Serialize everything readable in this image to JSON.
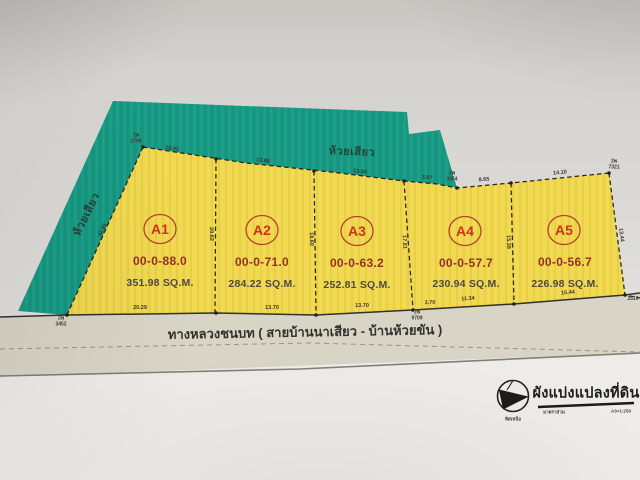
{
  "colors": {
    "teal": "#149a84",
    "yellow": "#f1d84d",
    "plot_red": "#d2311f",
    "rai_red": "#963122",
    "circle_red": "#b5402c",
    "line": "#26251f",
    "road_band": "#d8d4c6",
    "paper_bottom": "#edece8"
  },
  "streams": {
    "top": "ห้วยเสียว",
    "left": "ห้วยเสียว"
  },
  "road": {
    "label": "ทางหลวงชนบท ( สายบ้านนาเสียว - บ้านห้วยขัน )"
  },
  "plots": [
    {
      "label": "A1",
      "rai": "00-0-88.0",
      "sqm": "351.98 SQ.M."
    },
    {
      "label": "A2",
      "rai": "00-0-71.0",
      "sqm": "284.22 SQ.M."
    },
    {
      "label": "A3",
      "rai": "00-0-63.2",
      "sqm": "252.81 SQ.M."
    },
    {
      "label": "A4",
      "rai": "00-0-57.7",
      "sqm": "230.94 SQ.M."
    },
    {
      "label": "A5",
      "rai": "00-0-56.7",
      "sqm": "226.98 SQ.M."
    }
  ],
  "dims": {
    "top": [
      "16.91",
      "13.86",
      "13.84",
      "3.67",
      "8.65",
      "14.10"
    ],
    "bottom": [
      "20.29",
      "13.70",
      "13.70",
      "3.70",
      "11.34",
      "15.44"
    ],
    "left_edge": "42.65",
    "dividers": [
      "20.62",
      "18.60",
      "17.81",
      "15.38"
    ],
    "right_edge": "13.44"
  },
  "markers": {
    "nw": {
      "l1": "2พ",
      "l2": "1790"
    },
    "arm": {
      "l1": "2พ",
      "l2": "3354"
    },
    "ne": {
      "l1": "2พ",
      "l2": "7321"
    },
    "sw": {
      "l1": "2พ",
      "l2": "3452"
    },
    "mid": {
      "l1": "2พ",
      "l2": "9709"
    },
    "se": {
      "l1": "2510",
      "l2": ""
    }
  },
  "titleblock": {
    "title": "ผังแบ่งแปลงที่ดิน",
    "north": "ทิศเหนือ",
    "scale_label": "มาตราส่วน",
    "scale_value": "A3=1:250"
  }
}
